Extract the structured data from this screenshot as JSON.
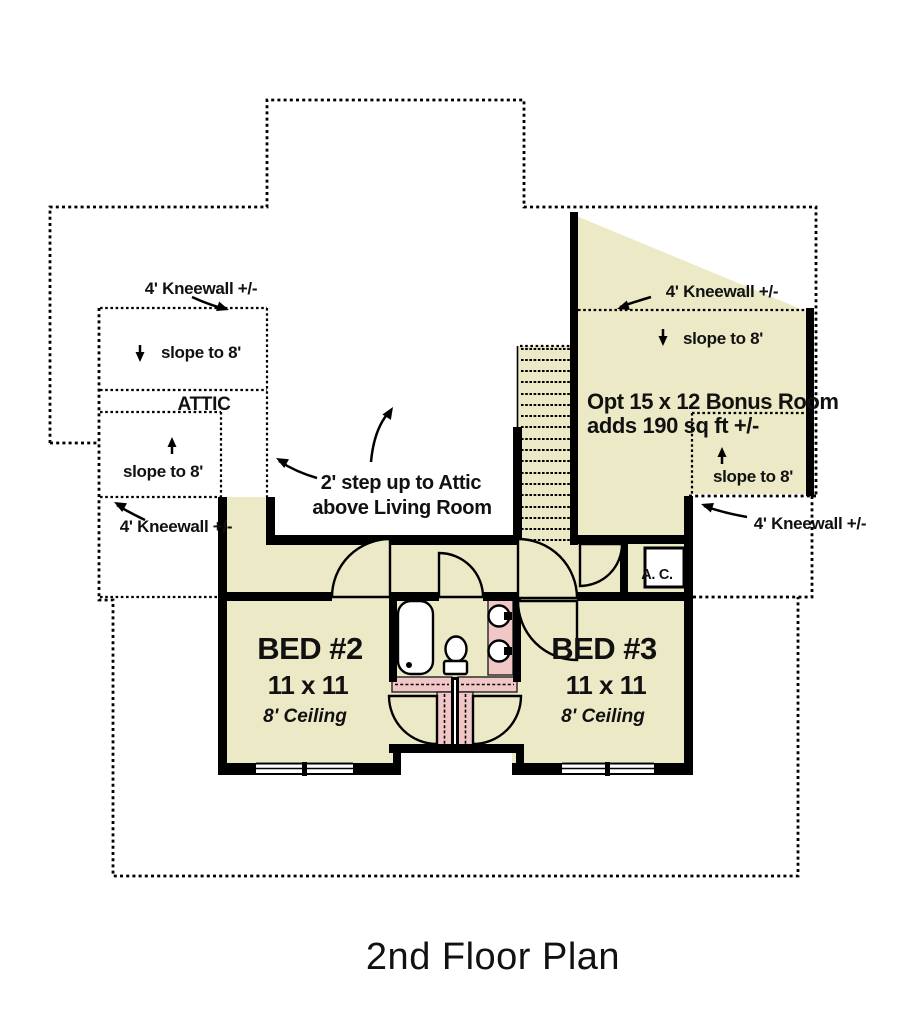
{
  "title": "2nd Floor Plan",
  "annotations": {
    "kneewall": "4' Kneewall +/-",
    "slope": "slope to 8'",
    "attic": "ATTIC",
    "step_up_line1": "2' step up to Attic",
    "step_up_line2": "above Living Room",
    "bonus_line1": "Opt 15 x 12 Bonus Room",
    "bonus_line2": "adds 190 sq ft +/-",
    "ac": "A. C."
  },
  "rooms": {
    "bed2": {
      "name": "BED #2",
      "size": "11 x 11",
      "ceiling": "8' Ceiling"
    },
    "bed3": {
      "name": "BED #3",
      "size": "11 x 11",
      "ceiling": "8' Ceiling"
    }
  },
  "colors": {
    "floor": "#ece9c6",
    "highlight_pink": "#f0c6c6",
    "wall": "#000000",
    "text": "#111111"
  }
}
